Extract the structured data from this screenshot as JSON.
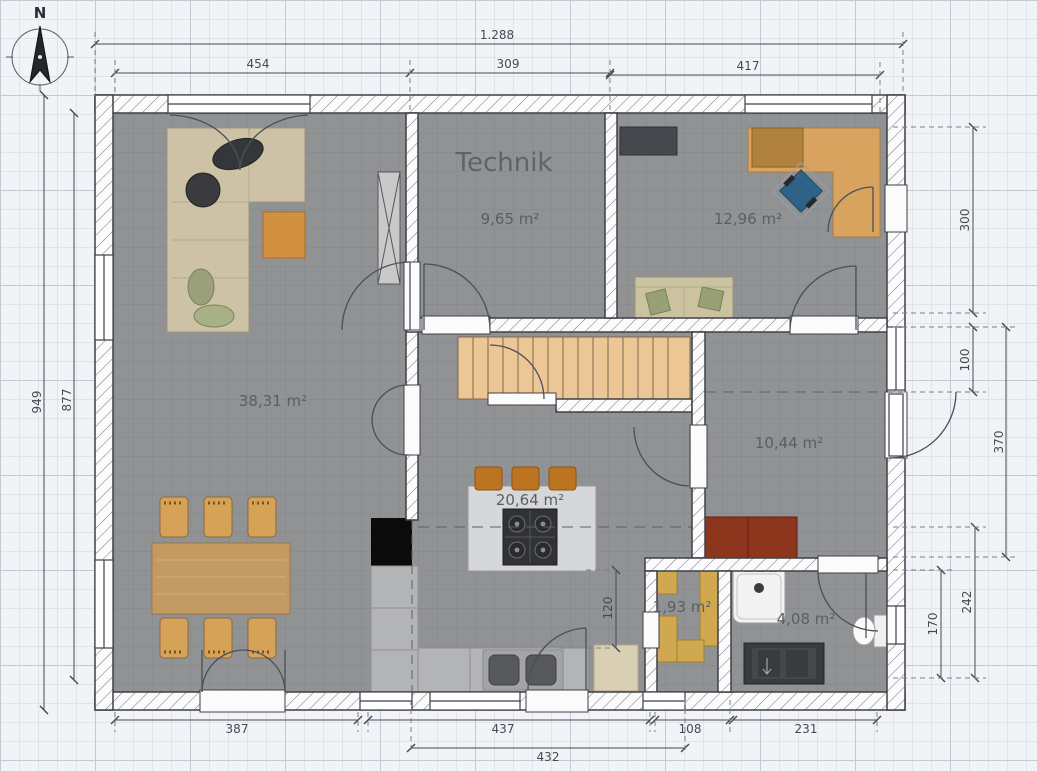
{
  "compass": {
    "north_label": "N"
  },
  "rooms": {
    "technik": {
      "name": "Technik",
      "area": "9,65 m²"
    },
    "office": {
      "area": "12,96 m²"
    },
    "living": {
      "area": "38,31 m²"
    },
    "kitchen": {
      "area": "20,64 m²"
    },
    "hall": {
      "area": "10,44 m²"
    },
    "storage": {
      "area": "1,93 m²"
    },
    "bathroom": {
      "area": "4,08 m²"
    }
  },
  "dimensions": {
    "top_total": "1.288",
    "top_left": "454",
    "top_middle": "309",
    "top_right": "417",
    "left_outer": "949",
    "left_inner": "877",
    "right_top": "300",
    "right_door": "100",
    "right_middle": "370",
    "right_lower": "242",
    "right_lower_inner": "170",
    "bottom_left": "387",
    "bottom_middle": "437",
    "bottom_small": "108",
    "bottom_right": "231",
    "bottom_inner": "432",
    "kitchen_passage": "120"
  },
  "colors": {
    "floor": "#909294",
    "wall_outline": "#3c4048",
    "stair_wood": "#ecc795",
    "table_wood": "#c49a63",
    "dimension_text": "#454a52"
  }
}
